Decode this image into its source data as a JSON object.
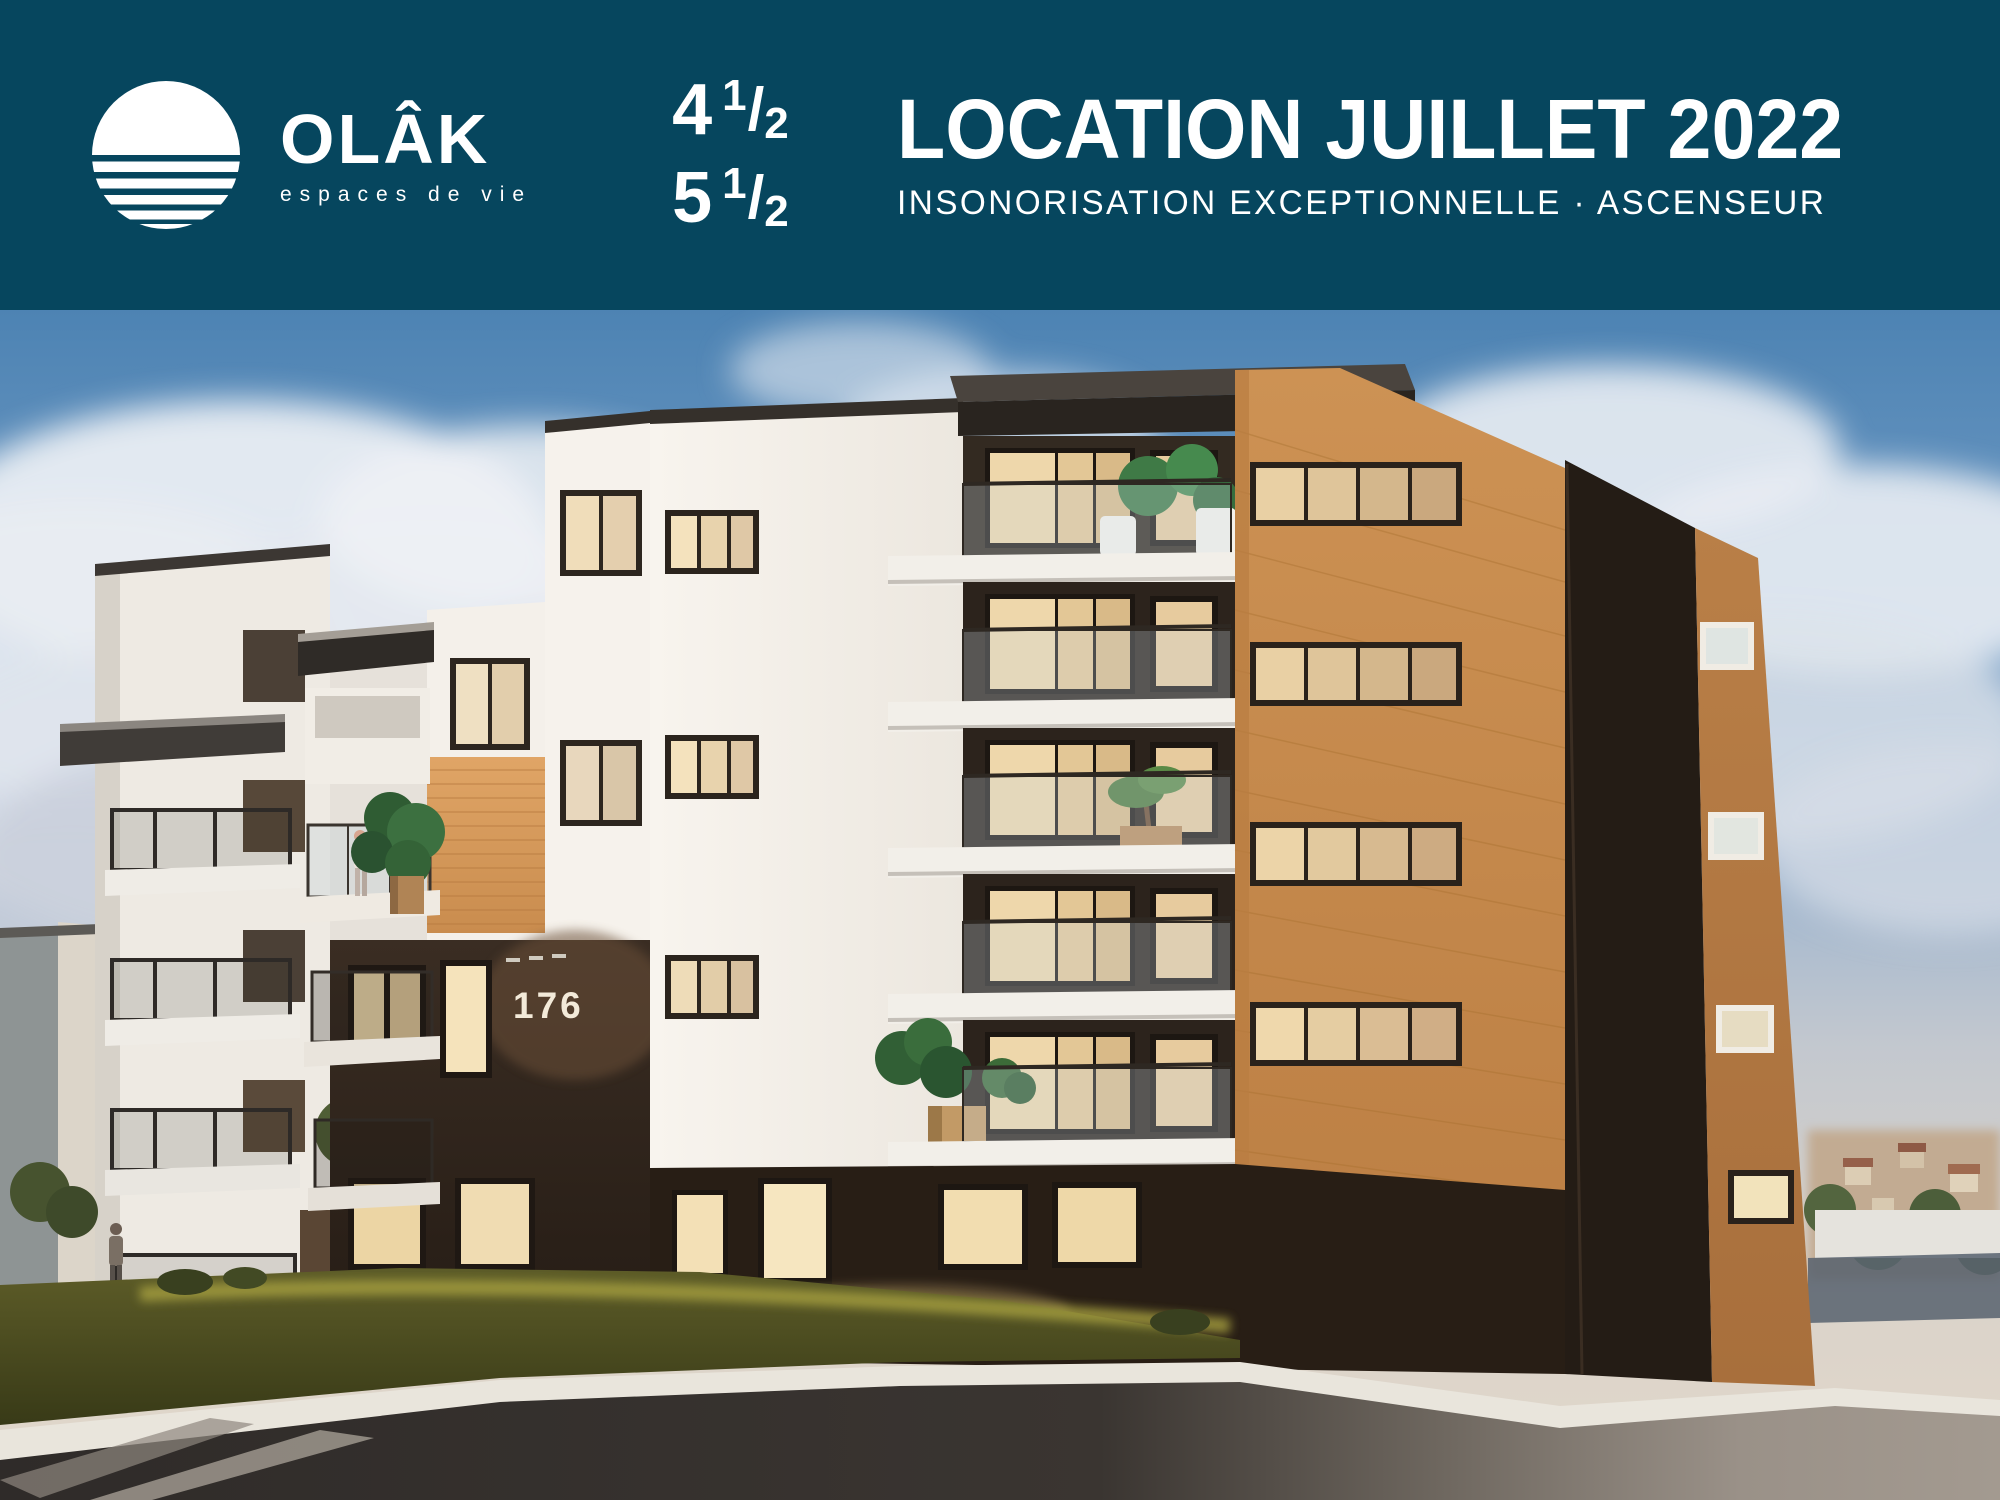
{
  "banner": {
    "background_color": "#06465e",
    "logo": {
      "brand": "OLÂK",
      "tagline": "espaces de vie",
      "icon": "sunset-over-water-icon"
    },
    "fraction_slash": "/",
    "units": [
      {
        "whole": "4",
        "numerator": "1",
        "denominator": "2"
      },
      {
        "whole": "5",
        "numerator": "1",
        "denominator": "2"
      }
    ],
    "title": "LOCATION JUILLET 2022",
    "subtitle": "INSONORISATION EXCEPTIONNELLE · ASCENSEUR"
  },
  "scene": {
    "building_number": "176"
  },
  "colors": {
    "banner_teal": "#06465e",
    "text_white": "#ffffff",
    "wood_orange": "#cf9254",
    "dark_brick": "#2b2118",
    "white_siding": "#f3efe9",
    "sky_blue": "#4d83b3",
    "grass_green": "#51511f",
    "asphalt_shadow": "#332f2c",
    "street_lit": "#9a9188",
    "window_glow": "#f0dcb2"
  }
}
